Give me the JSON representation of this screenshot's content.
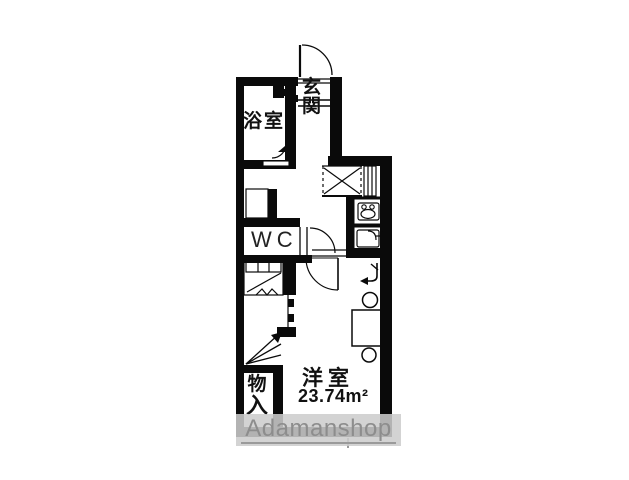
{
  "plan": {
    "type": "apartment-floor-plan",
    "labels": {
      "entrance_char1": "玄",
      "entrance_char2": "関",
      "bathroom": "浴室",
      "toilet": "WC",
      "storage_char1": "物",
      "storage_char2": "入",
      "main_room": "洋室",
      "main_room_area": "23.74m²"
    },
    "watermark": "Adamanshop",
    "colors": {
      "wall": "#0a0a0a",
      "background": "#ffffff",
      "watermark_band": "#cccccc",
      "watermark_text": "#8d8d8d"
    }
  }
}
